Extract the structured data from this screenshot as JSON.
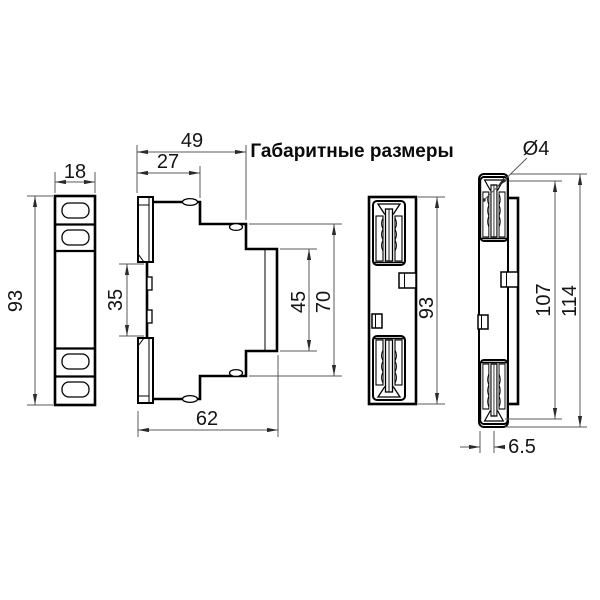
{
  "title": "Габаритные размеры",
  "colors": {
    "ink": "#000000",
    "dimension_lines": "#5a5a5a",
    "background": "#ffffff"
  },
  "dimensions": {
    "front_width": "18",
    "front_height": "93",
    "side_total_depth": "49",
    "side_upper_depth": "27",
    "din_recess_height": "35",
    "front_panel_height": "45",
    "front_block_height": "70",
    "side_lower_depth": "62",
    "rear_height": "93",
    "hole_diameter": "Ø4",
    "mounting_height": "107",
    "overall_height": "114",
    "panel_thickness": "6.5"
  }
}
